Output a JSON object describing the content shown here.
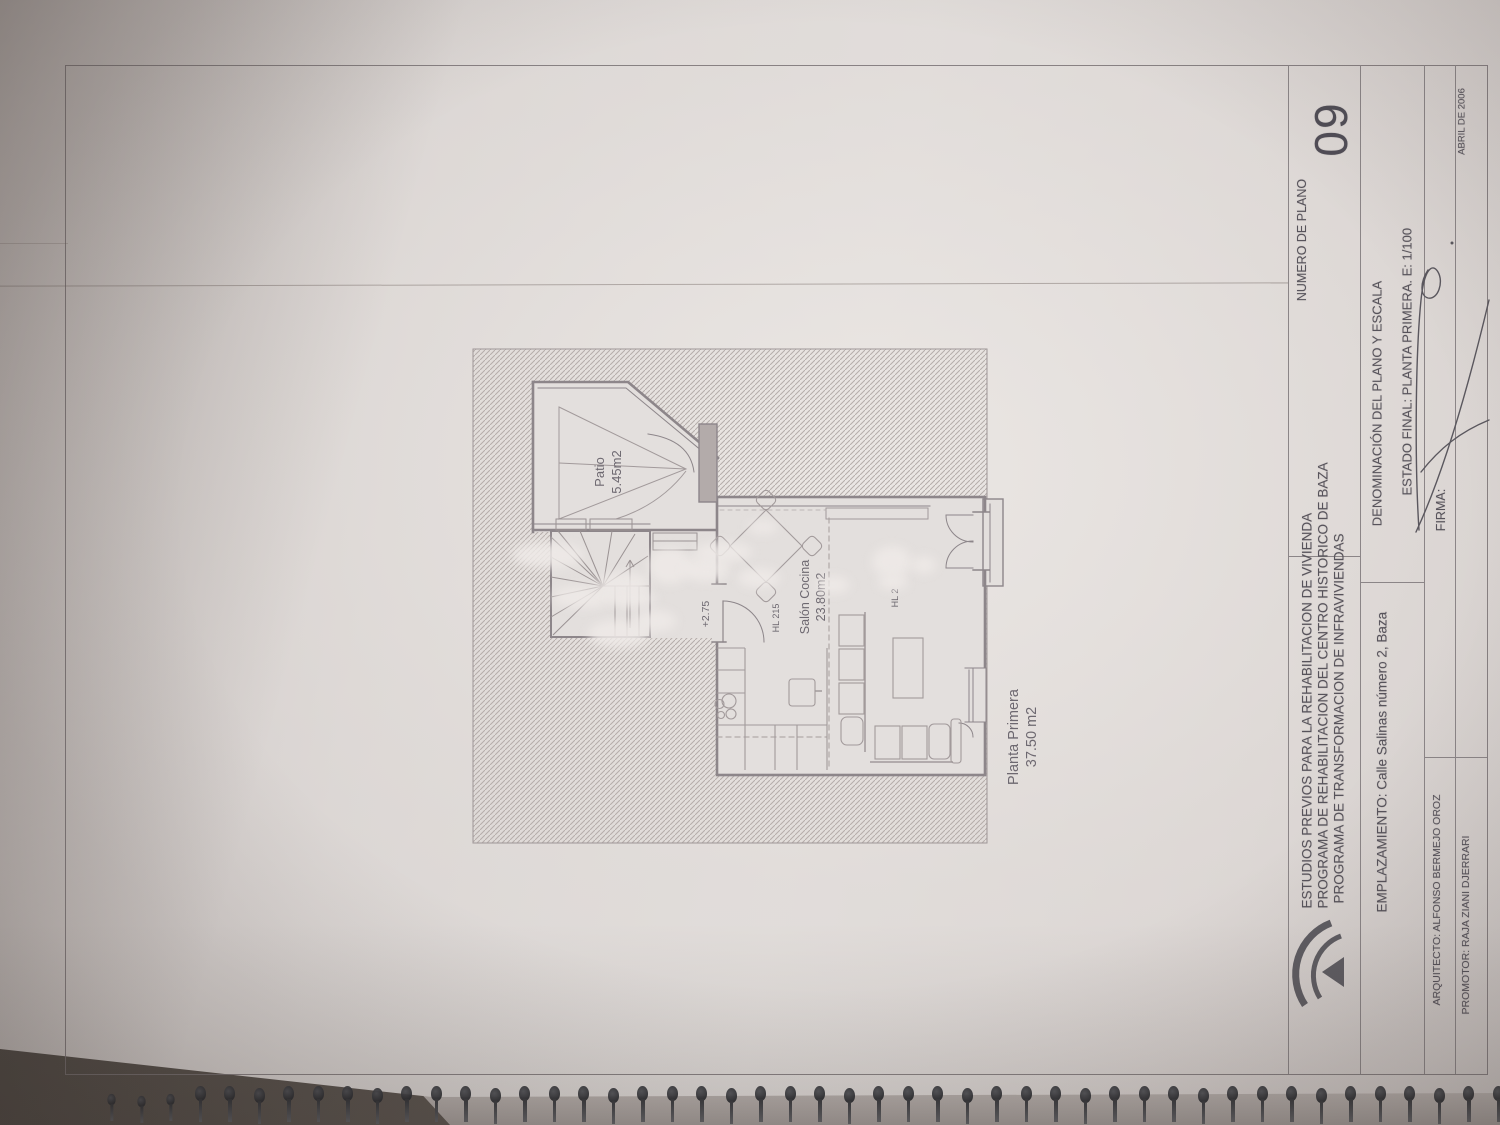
{
  "title_block": {
    "org_lines": [
      "ESTUDIOS PREVIOS PARA LA REHABILITACION DE VIVIENDA",
      "PROGRAMA DE REHABILITACION DEL CENTRO HISTORICO DE BAZA",
      "PROGRAMA DE TRANSFORMACION DE INFRAVIVIENDAS"
    ],
    "emplazamiento": "EMPLAZAMIENTO: Calle Salinas número 2, Baza",
    "numero_label": "NUMERO DE PLANO",
    "numero_value": "09",
    "denominacion_label": "DENOMINACIÓN DEL PLANO Y ESCALA",
    "estado_line": "ESTADO FINAL: PLANTA PRIMERA. E: 1/100",
    "firma_label": "FIRMA:",
    "arquitecto": "ARQUITECTO: ALFONSO BERMEJO OROZ",
    "promotor": "PROMOTOR: RAJA ZIANI DJERRARI",
    "fecha": "ABRIL DE 2006",
    "logo": "junta-de-andalucia-logo"
  },
  "plan": {
    "patio_name": "Patio",
    "patio_area": "5.45m2",
    "salon_name": "Salón Cocina",
    "salon_area": "23.80m2",
    "hl_1": "HL 215",
    "hl_2": "HL 2",
    "level": "+2.75",
    "floor_name": "Planta Primera",
    "floor_area": "37.50 m2"
  },
  "binding": {
    "pin_count": 48
  },
  "watermark_blobs": [
    [
      512,
      542,
      72,
      26
    ],
    [
      552,
      586,
      62,
      22
    ],
    [
      596,
      572,
      54,
      26
    ],
    [
      608,
      590,
      48,
      18
    ],
    [
      648,
      548,
      44,
      36
    ],
    [
      683,
      556,
      46,
      26
    ],
    [
      694,
      542,
      58,
      20
    ],
    [
      738,
      568,
      42,
      20
    ],
    [
      816,
      576,
      34,
      18
    ],
    [
      872,
      546,
      40,
      32
    ],
    [
      878,
      574,
      30,
      16
    ],
    [
      912,
      556,
      24,
      18
    ],
    [
      588,
      620,
      62,
      28
    ],
    [
      634,
      610,
      42,
      22
    ],
    [
      748,
      520,
      30,
      14
    ]
  ],
  "colors": {
    "paper": "#ddd8d5",
    "ink": "#57535b",
    "plan-line": "#8d868a",
    "hatch": "#b5adaa",
    "background": "#554f4a",
    "pin": "#32343a"
  }
}
